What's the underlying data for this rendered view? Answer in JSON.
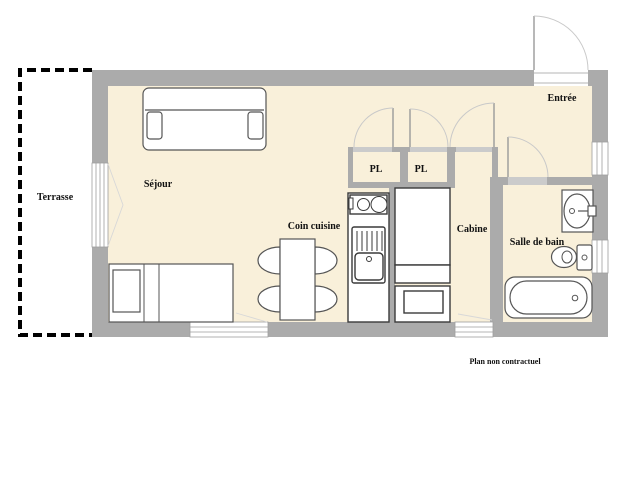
{
  "labels": {
    "terrasse": "Terrasse",
    "sejour": "Séjour",
    "coin_cuisine": "Coin cuisine",
    "pl_left": "PL",
    "pl_right": "PL",
    "cabine": "Cabine",
    "entree": "Entrée",
    "salle_de_bain": "Salle de bain",
    "footnote": "Plan non contractuel"
  },
  "colors": {
    "background": "#ffffff",
    "wall": "#ababab",
    "sill": "#cbcbcb",
    "floor": "#f9f0da",
    "outline": "#555555",
    "furniture_dark": "#3a3a3a",
    "door_arc": "#c9c9c9",
    "door_leaf": "#9a9a9a",
    "window_frame": "#9e9e9e",
    "opening_line": "#d8d8d8",
    "text": "#111111",
    "terrace_dash": "#000000"
  }
}
